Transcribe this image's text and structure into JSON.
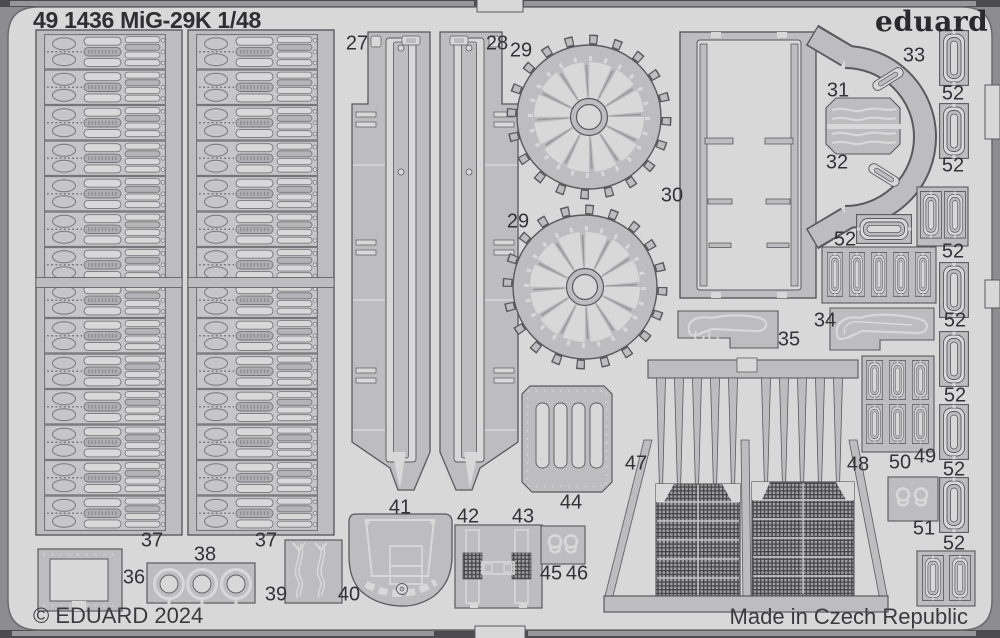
{
  "sheet": {
    "title": "49 1436 MiG-29K  1/48",
    "brand": "eduard",
    "copyright": "© EDUARD 2024",
    "made_in": "Made in Czech Republic"
  },
  "colors": {
    "background": "#8d8d8f",
    "edge_band": "#4c4c4f",
    "sheet": "#d8d8d8",
    "part_fill": "#bdbdbf",
    "part_outline": "#5a5a5e",
    "text": "#333337"
  },
  "part_labels": [
    {
      "n": "27",
      "x": 357,
      "y": 44
    },
    {
      "n": "28",
      "x": 497,
      "y": 44
    },
    {
      "n": "29",
      "x": 521,
      "y": 51
    },
    {
      "n": "29",
      "x": 518,
      "y": 222
    },
    {
      "n": "30",
      "x": 672,
      "y": 196
    },
    {
      "n": "31",
      "x": 838,
      "y": 91
    },
    {
      "n": "32",
      "x": 837,
      "y": 163
    },
    {
      "n": "33",
      "x": 914,
      "y": 56
    },
    {
      "n": "34",
      "x": 825,
      "y": 321
    },
    {
      "n": "35",
      "x": 789,
      "y": 340
    },
    {
      "n": "36",
      "x": 134,
      "y": 578
    },
    {
      "n": "37",
      "x": 152,
      "y": 541
    },
    {
      "n": "37",
      "x": 266,
      "y": 541
    },
    {
      "n": "38",
      "x": 205,
      "y": 555
    },
    {
      "n": "39",
      "x": 276,
      "y": 595
    },
    {
      "n": "40",
      "x": 349,
      "y": 595
    },
    {
      "n": "41",
      "x": 400,
      "y": 508
    },
    {
      "n": "42",
      "x": 468,
      "y": 517
    },
    {
      "n": "43",
      "x": 523,
      "y": 517
    },
    {
      "n": "44",
      "x": 571,
      "y": 503
    },
    {
      "n": "45",
      "x": 551,
      "y": 574
    },
    {
      "n": "46",
      "x": 577,
      "y": 574
    },
    {
      "n": "47",
      "x": 636,
      "y": 464
    },
    {
      "n": "48",
      "x": 858,
      "y": 465
    },
    {
      "n": "49",
      "x": 925,
      "y": 457
    },
    {
      "n": "50",
      "x": 900,
      "y": 463
    },
    {
      "n": "51",
      "x": 924,
      "y": 529
    },
    {
      "n": "52",
      "x": 953,
      "y": 94
    },
    {
      "n": "52",
      "x": 953,
      "y": 166
    },
    {
      "n": "52",
      "x": 845,
      "y": 240
    },
    {
      "n": "52",
      "x": 953,
      "y": 252
    },
    {
      "n": "52",
      "x": 955,
      "y": 321
    },
    {
      "n": "52",
      "x": 955,
      "y": 396
    },
    {
      "n": "52",
      "x": 954,
      "y": 470
    },
    {
      "n": "52",
      "x": 954,
      "y": 544
    }
  ]
}
